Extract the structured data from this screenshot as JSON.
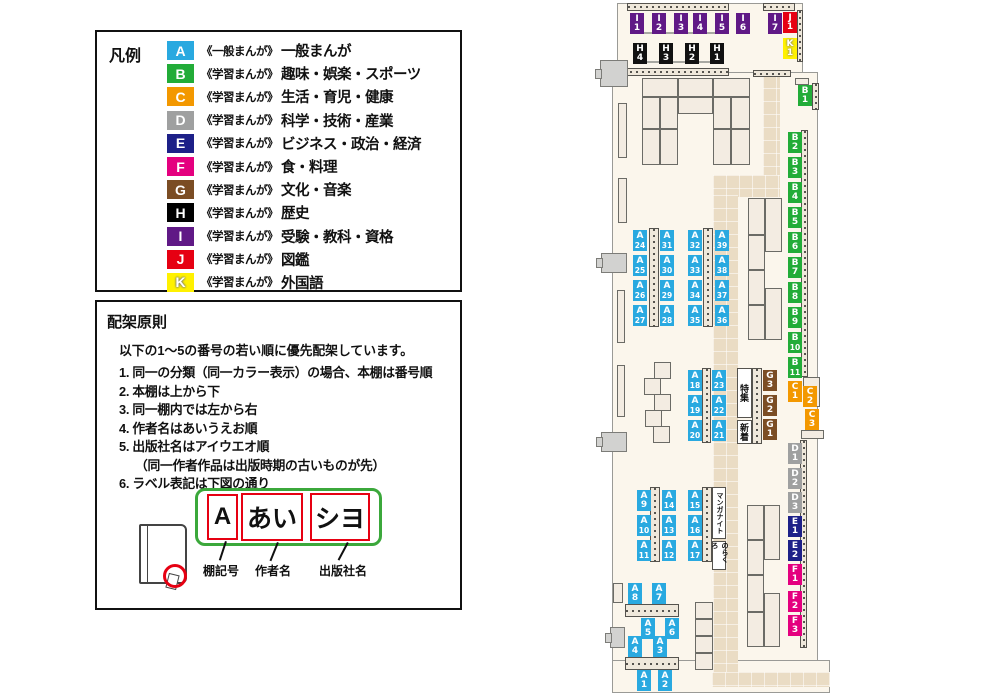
{
  "legend": {
    "title": "凡例",
    "items": [
      {
        "code": "A",
        "color": "#29A9E0",
        "series": "《一般まんが》",
        "label": "一般まんが"
      },
      {
        "code": "B",
        "color": "#22AC38",
        "series": "《学習まんが》",
        "label": "趣味・娯楽・スポーツ"
      },
      {
        "code": "C",
        "color": "#F39800",
        "series": "《学習まんが》",
        "label": "生活・育児・健康"
      },
      {
        "code": "D",
        "color": "#9FA0A0",
        "series": "《学習まんが》",
        "label": "科学・技術・産業"
      },
      {
        "code": "E",
        "color": "#1D2088",
        "series": "《学習まんが》",
        "label": "ビジネス・政治・経済"
      },
      {
        "code": "F",
        "color": "#E4007F",
        "series": "《学習まんが》",
        "label": "食・料理"
      },
      {
        "code": "G",
        "color": "#7B4D24",
        "series": "《学習まんが》",
        "label": "文化・音楽"
      },
      {
        "code": "H",
        "color": "#000000",
        "series": "《学習まんが》",
        "label": "歴史"
      },
      {
        "code": "I",
        "color": "#601986",
        "series": "《学習まんが》",
        "label": "受験・教科・資格"
      },
      {
        "code": "J",
        "color": "#E60012",
        "series": "《学習まんが》",
        "label": "図鑑"
      },
      {
        "code": "K",
        "color": "#FFF100",
        "series": "《学習まんが》",
        "label": "外国語"
      }
    ]
  },
  "principles": {
    "title": "配架原則",
    "intro": "以下の1～5の番号の若い順に優先配架しています。",
    "items": [
      {
        "text": "1. 同一の分類（同一カラー表示）の場合、本棚は番号順",
        "indent": false
      },
      {
        "text": "2. 本棚は上から下",
        "indent": false
      },
      {
        "text": "3. 同一棚内では左から右",
        "indent": false
      },
      {
        "text": "4. 作者名はあいうえお順",
        "indent": false
      },
      {
        "text": "5. 出版社名はアイウエオ順",
        "indent": false
      },
      {
        "text": "（同一作者作品は出版時期の古いものが先）",
        "indent": true
      },
      {
        "text": "6. ラベル表記は下図の通り",
        "indent": false
      }
    ]
  },
  "label_example": {
    "shelf_code": "A",
    "author": "あい",
    "publisher": "シヨ",
    "captions": [
      "棚記号",
      "作者名",
      "出版社名"
    ]
  },
  "map": {
    "category_colors": {
      "A": "#29A9E0",
      "B": "#22AC38",
      "C": "#F39800",
      "D": "#9FA0A0",
      "E": "#1D2088",
      "F": "#E4007F",
      "G": "#7B4D24",
      "H": "#111111",
      "I": "#601986",
      "J": "#E60012",
      "K": "#FFF100"
    },
    "labels": [
      {
        "id": "I1",
        "x": 630,
        "y": 13
      },
      {
        "id": "I2",
        "x": 652,
        "y": 13
      },
      {
        "id": "I3",
        "x": 674,
        "y": 13
      },
      {
        "id": "I4",
        "x": 693,
        "y": 13
      },
      {
        "id": "I5",
        "x": 715,
        "y": 13
      },
      {
        "id": "I6",
        "x": 736,
        "y": 13
      },
      {
        "id": "I7",
        "x": 768,
        "y": 13
      },
      {
        "id": "J1",
        "x": 783,
        "y": 12
      },
      {
        "id": "K1",
        "x": 783,
        "y": 38
      },
      {
        "id": "H4",
        "x": 633,
        "y": 43
      },
      {
        "id": "H3",
        "x": 659,
        "y": 43
      },
      {
        "id": "H2",
        "x": 685,
        "y": 43
      },
      {
        "id": "H1",
        "x": 710,
        "y": 43
      },
      {
        "id": "B1",
        "x": 798,
        "y": 85
      },
      {
        "id": "B2",
        "x": 788,
        "y": 132
      },
      {
        "id": "B3",
        "x": 788,
        "y": 157
      },
      {
        "id": "B4",
        "x": 788,
        "y": 182
      },
      {
        "id": "B5",
        "x": 788,
        "y": 207
      },
      {
        "id": "B6",
        "x": 788,
        "y": 232
      },
      {
        "id": "B7",
        "x": 788,
        "y": 257
      },
      {
        "id": "B8",
        "x": 788,
        "y": 282
      },
      {
        "id": "B9",
        "x": 788,
        "y": 307
      },
      {
        "id": "B10",
        "x": 788,
        "y": 332
      },
      {
        "id": "B11",
        "x": 788,
        "y": 357
      },
      {
        "id": "C1",
        "x": 788,
        "y": 381
      },
      {
        "id": "C2",
        "x": 803,
        "y": 386
      },
      {
        "id": "C3",
        "x": 805,
        "y": 409
      },
      {
        "id": "G3",
        "x": 763,
        "y": 370
      },
      {
        "id": "G2",
        "x": 763,
        "y": 395
      },
      {
        "id": "G1",
        "x": 763,
        "y": 419
      },
      {
        "id": "D1",
        "x": 788,
        "y": 443
      },
      {
        "id": "D2",
        "x": 788,
        "y": 468
      },
      {
        "id": "D3",
        "x": 788,
        "y": 492
      },
      {
        "id": "E1",
        "x": 788,
        "y": 516
      },
      {
        "id": "E2",
        "x": 788,
        "y": 540
      },
      {
        "id": "F1",
        "x": 788,
        "y": 564
      },
      {
        "id": "F2",
        "x": 788,
        "y": 591
      },
      {
        "id": "F3",
        "x": 788,
        "y": 615
      },
      {
        "id": "A24",
        "x": 633,
        "y": 230
      },
      {
        "id": "A25",
        "x": 633,
        "y": 255
      },
      {
        "id": "A26",
        "x": 633,
        "y": 280
      },
      {
        "id": "A27",
        "x": 633,
        "y": 305
      },
      {
        "id": "A31",
        "x": 660,
        "y": 230
      },
      {
        "id": "A30",
        "x": 660,
        "y": 255
      },
      {
        "id": "A29",
        "x": 660,
        "y": 280
      },
      {
        "id": "A28",
        "x": 660,
        "y": 305
      },
      {
        "id": "A32",
        "x": 688,
        "y": 230
      },
      {
        "id": "A33",
        "x": 688,
        "y": 255
      },
      {
        "id": "A34",
        "x": 688,
        "y": 280
      },
      {
        "id": "A35",
        "x": 688,
        "y": 305
      },
      {
        "id": "A39",
        "x": 715,
        "y": 230
      },
      {
        "id": "A38",
        "x": 715,
        "y": 255
      },
      {
        "id": "A37",
        "x": 715,
        "y": 280
      },
      {
        "id": "A36",
        "x": 715,
        "y": 305
      },
      {
        "id": "A18",
        "x": 688,
        "y": 370
      },
      {
        "id": "A19",
        "x": 688,
        "y": 395
      },
      {
        "id": "A20",
        "x": 688,
        "y": 420
      },
      {
        "id": "A23",
        "x": 712,
        "y": 370
      },
      {
        "id": "A22",
        "x": 712,
        "y": 395
      },
      {
        "id": "A21",
        "x": 712,
        "y": 420
      },
      {
        "id": "A9",
        "x": 637,
        "y": 490
      },
      {
        "id": "A10",
        "x": 637,
        "y": 515
      },
      {
        "id": "A11",
        "x": 637,
        "y": 540
      },
      {
        "id": "A14",
        "x": 662,
        "y": 490
      },
      {
        "id": "A13",
        "x": 662,
        "y": 515
      },
      {
        "id": "A12",
        "x": 662,
        "y": 540
      },
      {
        "id": "A15",
        "x": 688,
        "y": 490
      },
      {
        "id": "A16",
        "x": 688,
        "y": 515
      },
      {
        "id": "A17",
        "x": 688,
        "y": 540
      },
      {
        "id": "A8",
        "x": 628,
        "y": 583
      },
      {
        "id": "A7",
        "x": 652,
        "y": 583
      },
      {
        "id": "A5",
        "x": 641,
        "y": 618
      },
      {
        "id": "A6",
        "x": 665,
        "y": 618
      },
      {
        "id": "A4",
        "x": 628,
        "y": 636
      },
      {
        "id": "A3",
        "x": 653,
        "y": 636
      },
      {
        "id": "A1",
        "x": 637,
        "y": 670
      },
      {
        "id": "A2",
        "x": 658,
        "y": 670
      }
    ],
    "areas": [
      {
        "id": "tokushu",
        "text": "特集",
        "x": 737,
        "y": 368,
        "w": 15,
        "h": 50,
        "fs": 9
      },
      {
        "id": "shinchaku",
        "text": "新着",
        "x": 737,
        "y": 420,
        "w": 15,
        "h": 24,
        "fs": 9
      },
      {
        "id": "manga-night",
        "text": "マンガナイト",
        "x": 712,
        "y": 487,
        "w": 14,
        "h": 52,
        "fs": 7
      },
      {
        "id": "norakuro",
        "text": "のらくろ",
        "x": 712,
        "y": 541,
        "w": 14,
        "h": 29,
        "fs": 7
      }
    ]
  }
}
